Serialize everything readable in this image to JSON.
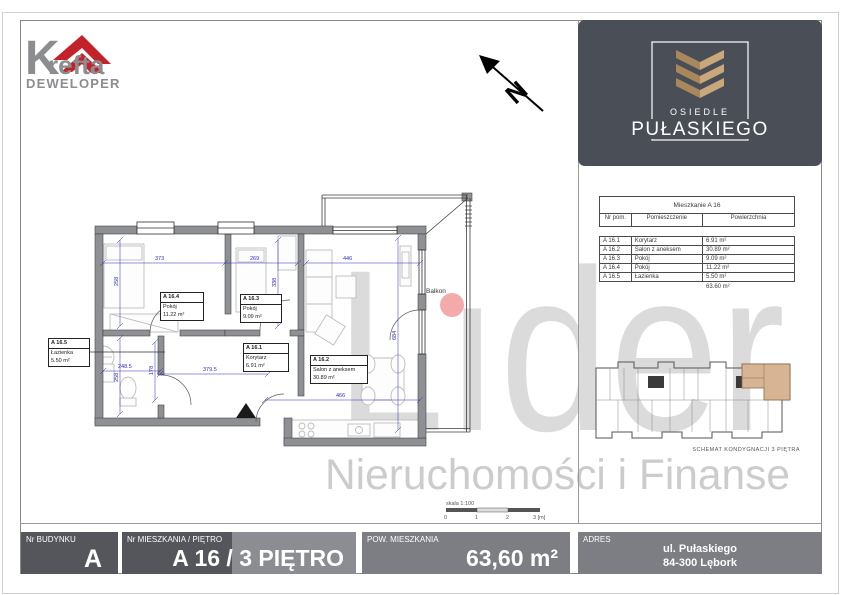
{
  "branding": {
    "developer": {
      "initial": "K",
      "rest": "refta",
      "subtitle": "DEWELOPER",
      "red": "#c4222a",
      "gray": "#8b8d90"
    },
    "estate": {
      "top": "OSIEDLE",
      "bottom": "PUŁASKIEGO",
      "box_color": "#4a4e56",
      "gold_dark": "#a8875c",
      "gold_light": "#c9a87c"
    }
  },
  "watermark": {
    "word": "Lıder",
    "caption": "Nieruchomości i Finanse",
    "dot_color": "#f2a5a5"
  },
  "plan": {
    "north": "N",
    "balcony_label": "Balkon",
    "rooms": [
      {
        "id": "A 16.4",
        "name": "Pokój",
        "area": "11.22 m²"
      },
      {
        "id": "A 16.3",
        "name": "Pokój",
        "area": "9.09 m²"
      },
      {
        "id": "A 16.1",
        "name": "Korytarz",
        "area": "6.91 m²"
      },
      {
        "id": "A 16.2",
        "name": "Salon z aneksem",
        "area": "30.89 m²"
      },
      {
        "id": "A 16.5",
        "name": "Łazienka",
        "area": "5.50 m²"
      }
    ],
    "dims": [
      "373",
      "269",
      "446",
      "258",
      "338",
      "684",
      "248.5",
      "178",
      "379.5",
      "466",
      "258"
    ],
    "scale": {
      "label": "skala 1:100",
      "ticks": [
        "0",
        "1",
        "2",
        "3 [m]"
      ]
    }
  },
  "table": {
    "title": "Mieszkanie  A 16",
    "columns": [
      "Nr pom.",
      "Pomieszczenie",
      "Powierzchnia"
    ],
    "rows": [
      {
        "id": "A 16.1",
        "name": "Korytarz",
        "area": "6.91 m²"
      },
      {
        "id": "A 16.2",
        "name": "Salon z aneksem",
        "area": "30.89 m²"
      },
      {
        "id": "A 16.3",
        "name": "Pokój",
        "area": "9.09 m²"
      },
      {
        "id": "A 16.4",
        "name": "Pokój",
        "area": "11.22 m²"
      },
      {
        "id": "A 16.5",
        "name": "Łazienka",
        "area": "5.50 m²"
      }
    ],
    "total": "63.60 m²"
  },
  "schematic": {
    "caption": "SCHEMAT KONDYGNACJI 3 PIĘTRA"
  },
  "footer": {
    "cells": [
      {
        "label": "Nr BUDYNKU",
        "value": "A"
      },
      {
        "label": "Nr MIESZKANIA / PIĘTRO",
        "value": "A 16 / 3 PIĘTRO"
      },
      {
        "label": "POW. MIESZKANIA",
        "value": "63,60 m²"
      },
      {
        "label": "ADRES",
        "value_line1": "ul. Pułaskiego",
        "value_line2": "84-300 Lębork"
      }
    ]
  }
}
